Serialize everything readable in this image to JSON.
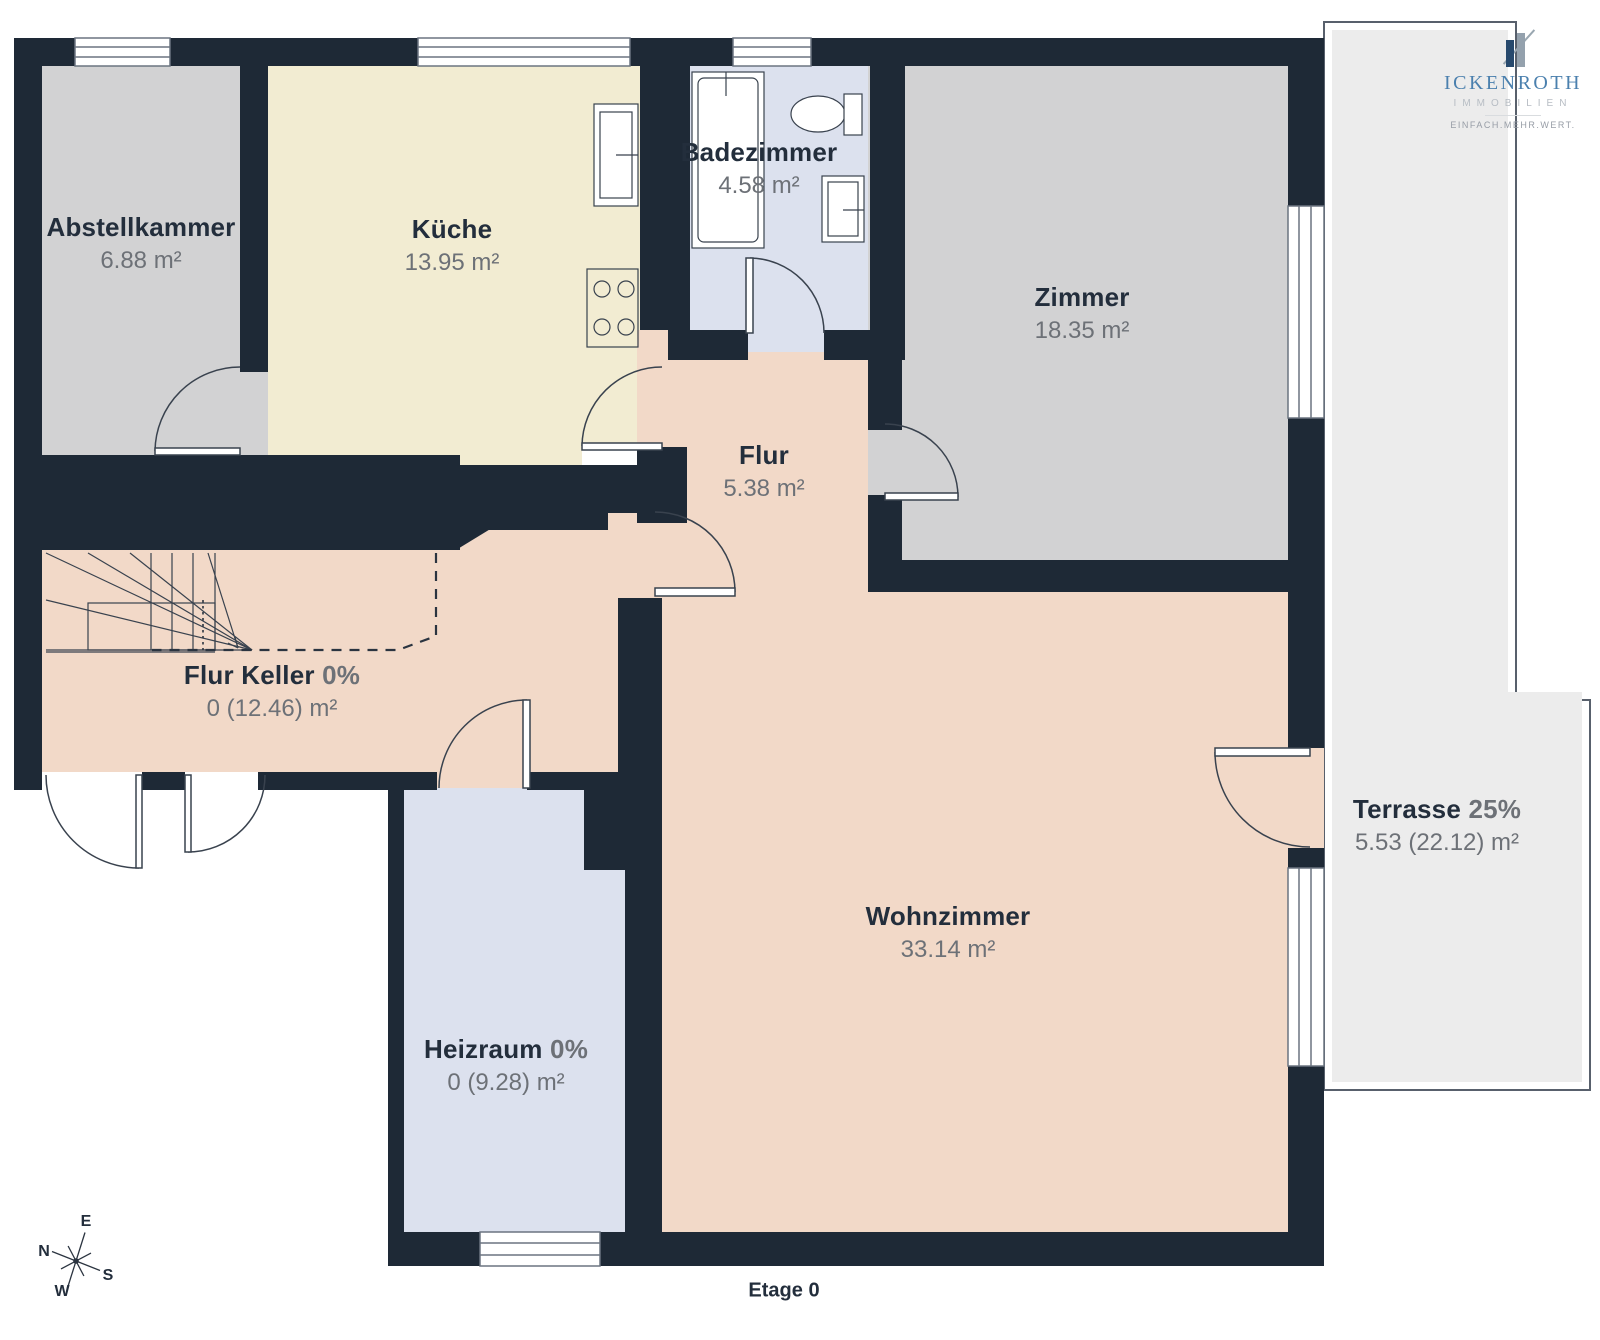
{
  "floor_label": "Etage 0",
  "rooms": [
    {
      "id": "abstellkammer",
      "name": "Abstellkammer",
      "badge": "",
      "area": "6.88 m²"
    },
    {
      "id": "kueche",
      "name": "Küche",
      "badge": "",
      "area": "13.95 m²"
    },
    {
      "id": "badezimmer",
      "name": "Badezimmer",
      "badge": "",
      "area": "4.58 m²"
    },
    {
      "id": "zimmer",
      "name": "Zimmer",
      "badge": "",
      "area": "18.35 m²"
    },
    {
      "id": "flur",
      "name": "Flur",
      "badge": "",
      "area": "5.38 m²"
    },
    {
      "id": "flur-keller",
      "name": "Flur Keller",
      "badge": "0%",
      "area": "0 (12.46) m²"
    },
    {
      "id": "heizraum",
      "name": "Heizraum",
      "badge": "0%",
      "area": "0 (9.28) m²"
    },
    {
      "id": "wohnzimmer",
      "name": "Wohnzimmer",
      "badge": "",
      "area": "33.14 m²"
    },
    {
      "id": "terrasse",
      "name": "Terrasse",
      "badge": "25%",
      "area": "5.53 (22.12) m²"
    }
  ],
  "compass": {
    "n": "N",
    "e": "E",
    "s": "S",
    "w": "W"
  },
  "logo": {
    "brand": "ICKENROTH",
    "subtitle": "IMMOBILIEN",
    "tagline": "EINFACH.MEHR.WERT."
  },
  "colors": {
    "wall": "#1e2936",
    "floor_peach": "#f2d9c8",
    "floor_cream": "#f2ecd2",
    "floor_gray": "#d2d2d3",
    "floor_lavender": "#dce1ee",
    "terrace": "#ececec",
    "label_dark": "#232e3c",
    "label_gray": "#6d7177",
    "brand_blue": "#4b80ae"
  }
}
